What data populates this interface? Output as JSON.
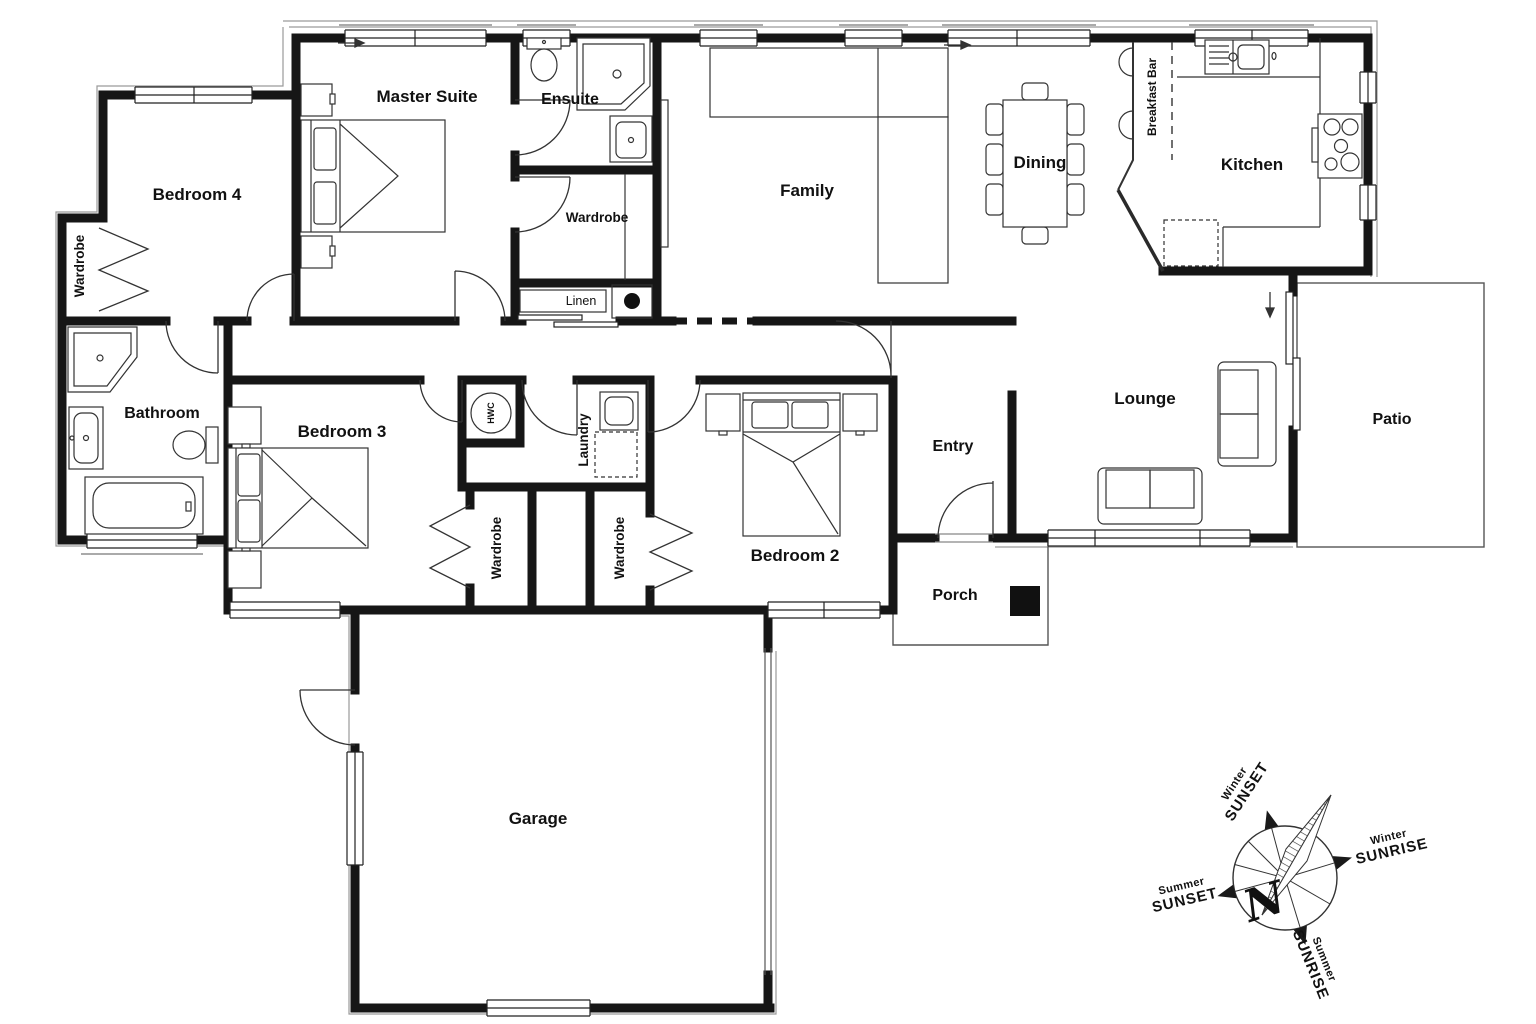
{
  "rooms": {
    "bedroom4": {
      "label": "Bedroom 4"
    },
    "master_suite": {
      "label": "Master Suite"
    },
    "ensuite": {
      "label": "Ensuite"
    },
    "wardrobe_master": {
      "label": "Wardrobe"
    },
    "wardrobe_bed4": {
      "label": "Wardrobe"
    },
    "wardrobe_bed3": {
      "label": "Wardrobe"
    },
    "wardrobe_bed2": {
      "label": "Wardrobe"
    },
    "linen": {
      "label": "Linen"
    },
    "family": {
      "label": "Family"
    },
    "dining": {
      "label": "Dining"
    },
    "breakfast_bar": {
      "label": "Breakfast Bar"
    },
    "kitchen": {
      "label": "Kitchen"
    },
    "bathroom": {
      "label": "Bathroom"
    },
    "bedroom3": {
      "label": "Bedroom 3"
    },
    "laundry": {
      "label": "Laundry"
    },
    "bedroom2": {
      "label": "Bedroom 2"
    },
    "entry": {
      "label": "Entry"
    },
    "lounge": {
      "label": "Lounge"
    },
    "patio": {
      "label": "Patio"
    },
    "porch": {
      "label": "Porch"
    },
    "garage": {
      "label": "Garage"
    },
    "hwc": {
      "label": "HWC"
    }
  },
  "compass": {
    "north": "N",
    "winter_sunset": {
      "line1": "Winter",
      "line2": "SUNSET"
    },
    "winter_sunrise": {
      "line1": "Winter",
      "line2": "SUNRISE"
    },
    "summer_sunset": {
      "line1": "Summer",
      "line2": "SUNSET"
    },
    "summer_sunrise": {
      "line1": "Summer",
      "line2": "SUNRISE"
    }
  },
  "colors": {
    "wall": "#161616",
    "furniture_line": "#333333",
    "eaves_line": "#999999",
    "background": "#ffffff"
  }
}
